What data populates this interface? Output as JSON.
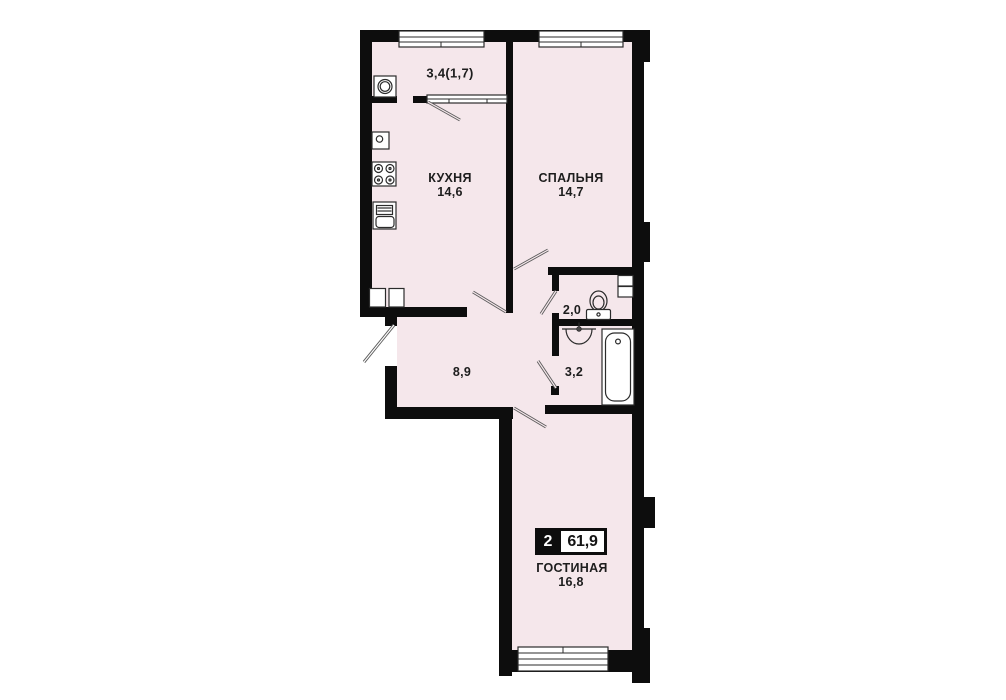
{
  "plan": {
    "badge": {
      "rooms": "2",
      "total_area": "61,9"
    },
    "rooms": [
      {
        "key": "balcony",
        "label": "",
        "area": "3,4(1,7)"
      },
      {
        "key": "kitchen",
        "label": "КУХНЯ",
        "area": "14,6"
      },
      {
        "key": "bedroom",
        "label": "СПАЛЬНЯ",
        "area": "14,7"
      },
      {
        "key": "wc",
        "label": "",
        "area": "2,0"
      },
      {
        "key": "bathroom",
        "label": "",
        "area": "3,2"
      },
      {
        "key": "hallway",
        "label": "",
        "area": "8,9"
      },
      {
        "key": "living_room",
        "label": "ГОСТИНАЯ",
        "area": "16,8"
      }
    ],
    "colors": {
      "room_fill": "#f5e7eb",
      "wall": "#0d0d0d",
      "line": "#5c5c5c"
    },
    "icons": [
      "washing-machine-icon",
      "counter-appliance-icon",
      "stove-icon",
      "kitchen-sink-icon",
      "toilet-icon",
      "washbasin-icon",
      "bathtub-icon",
      "vent-shaft-icon"
    ]
  }
}
